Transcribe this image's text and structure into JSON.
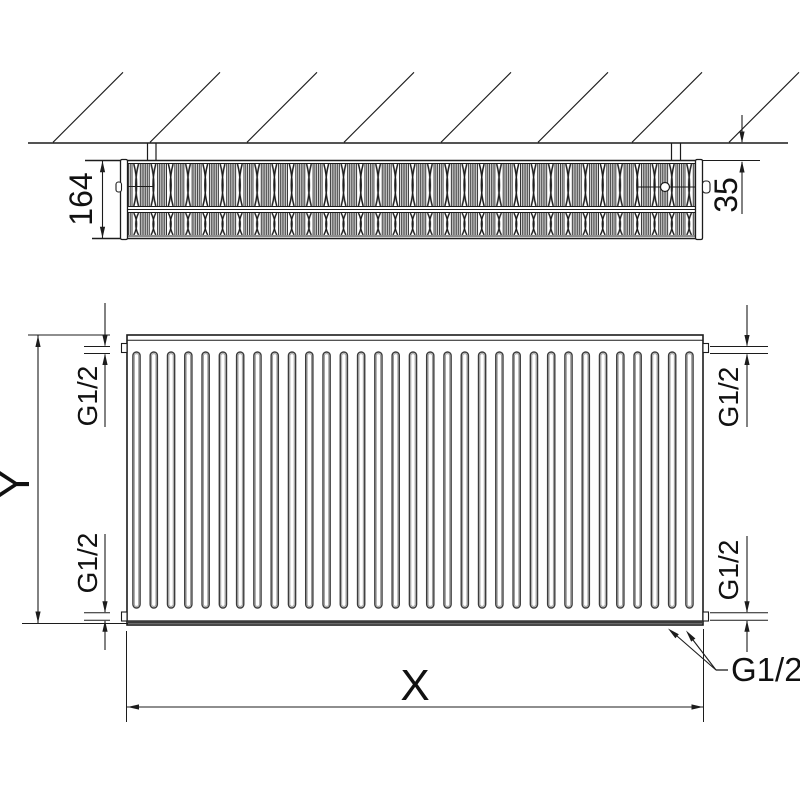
{
  "drawing": {
    "title": "Panel radiator technical dimension drawing",
    "colors": {
      "line": "#1c1c1c",
      "background": "#ffffff",
      "slot_outline": "#3c3c3c",
      "slot_inner": "#9a9a9a"
    },
    "top_view": {
      "depth_dimension": "164",
      "wall_distance_dimension": "35"
    },
    "front_view": {
      "height_dimension_label": "Y",
      "length_dimension_label": "X",
      "connection_top_left": "G1/2",
      "connection_bottom_left": "G1/2",
      "connection_top_right": "G1/2",
      "connection_bottom_right": "G1/2",
      "connection_bottom_callout": "G1/2"
    }
  }
}
